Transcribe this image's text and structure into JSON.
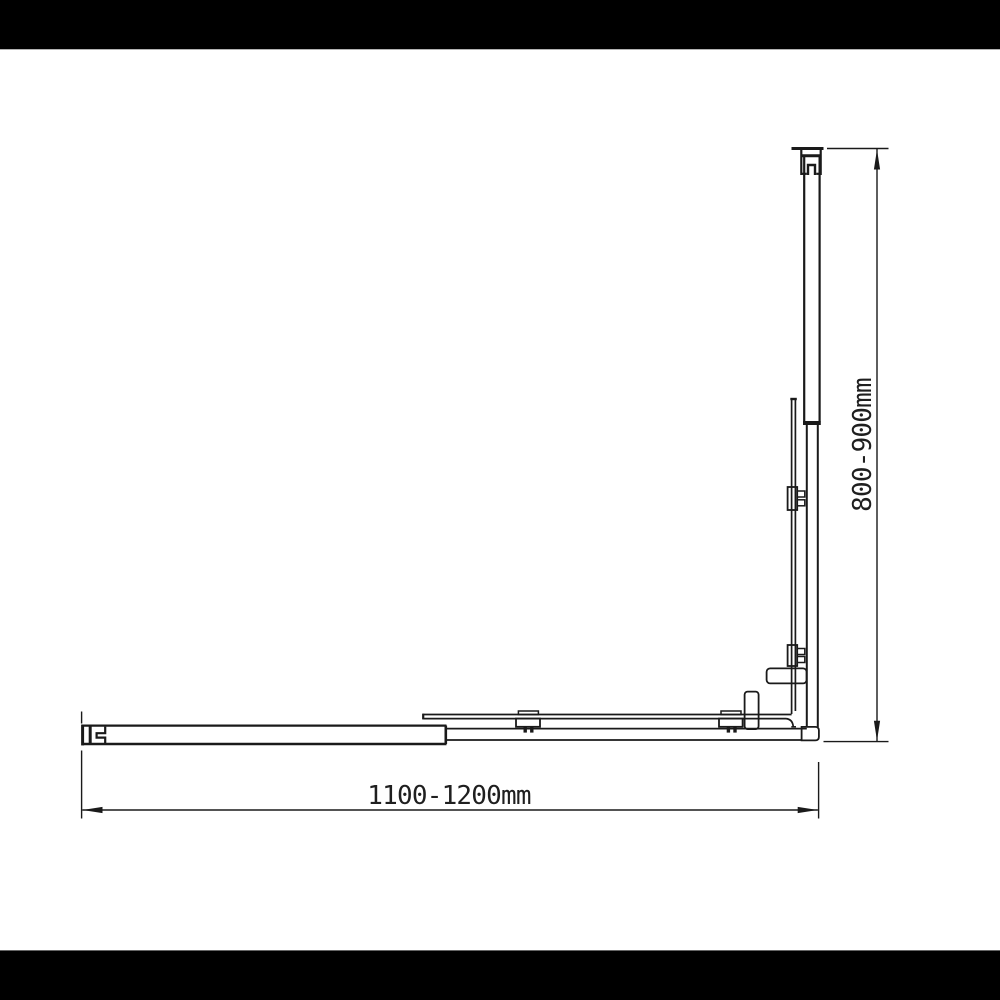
{
  "colors": {
    "line": "#1a1a1a",
    "background": "#ffffff",
    "letterbox": "#000000"
  },
  "dimensions": {
    "width": {
      "label": "1100-1200mm"
    },
    "height": {
      "label": "800-900mm"
    }
  }
}
